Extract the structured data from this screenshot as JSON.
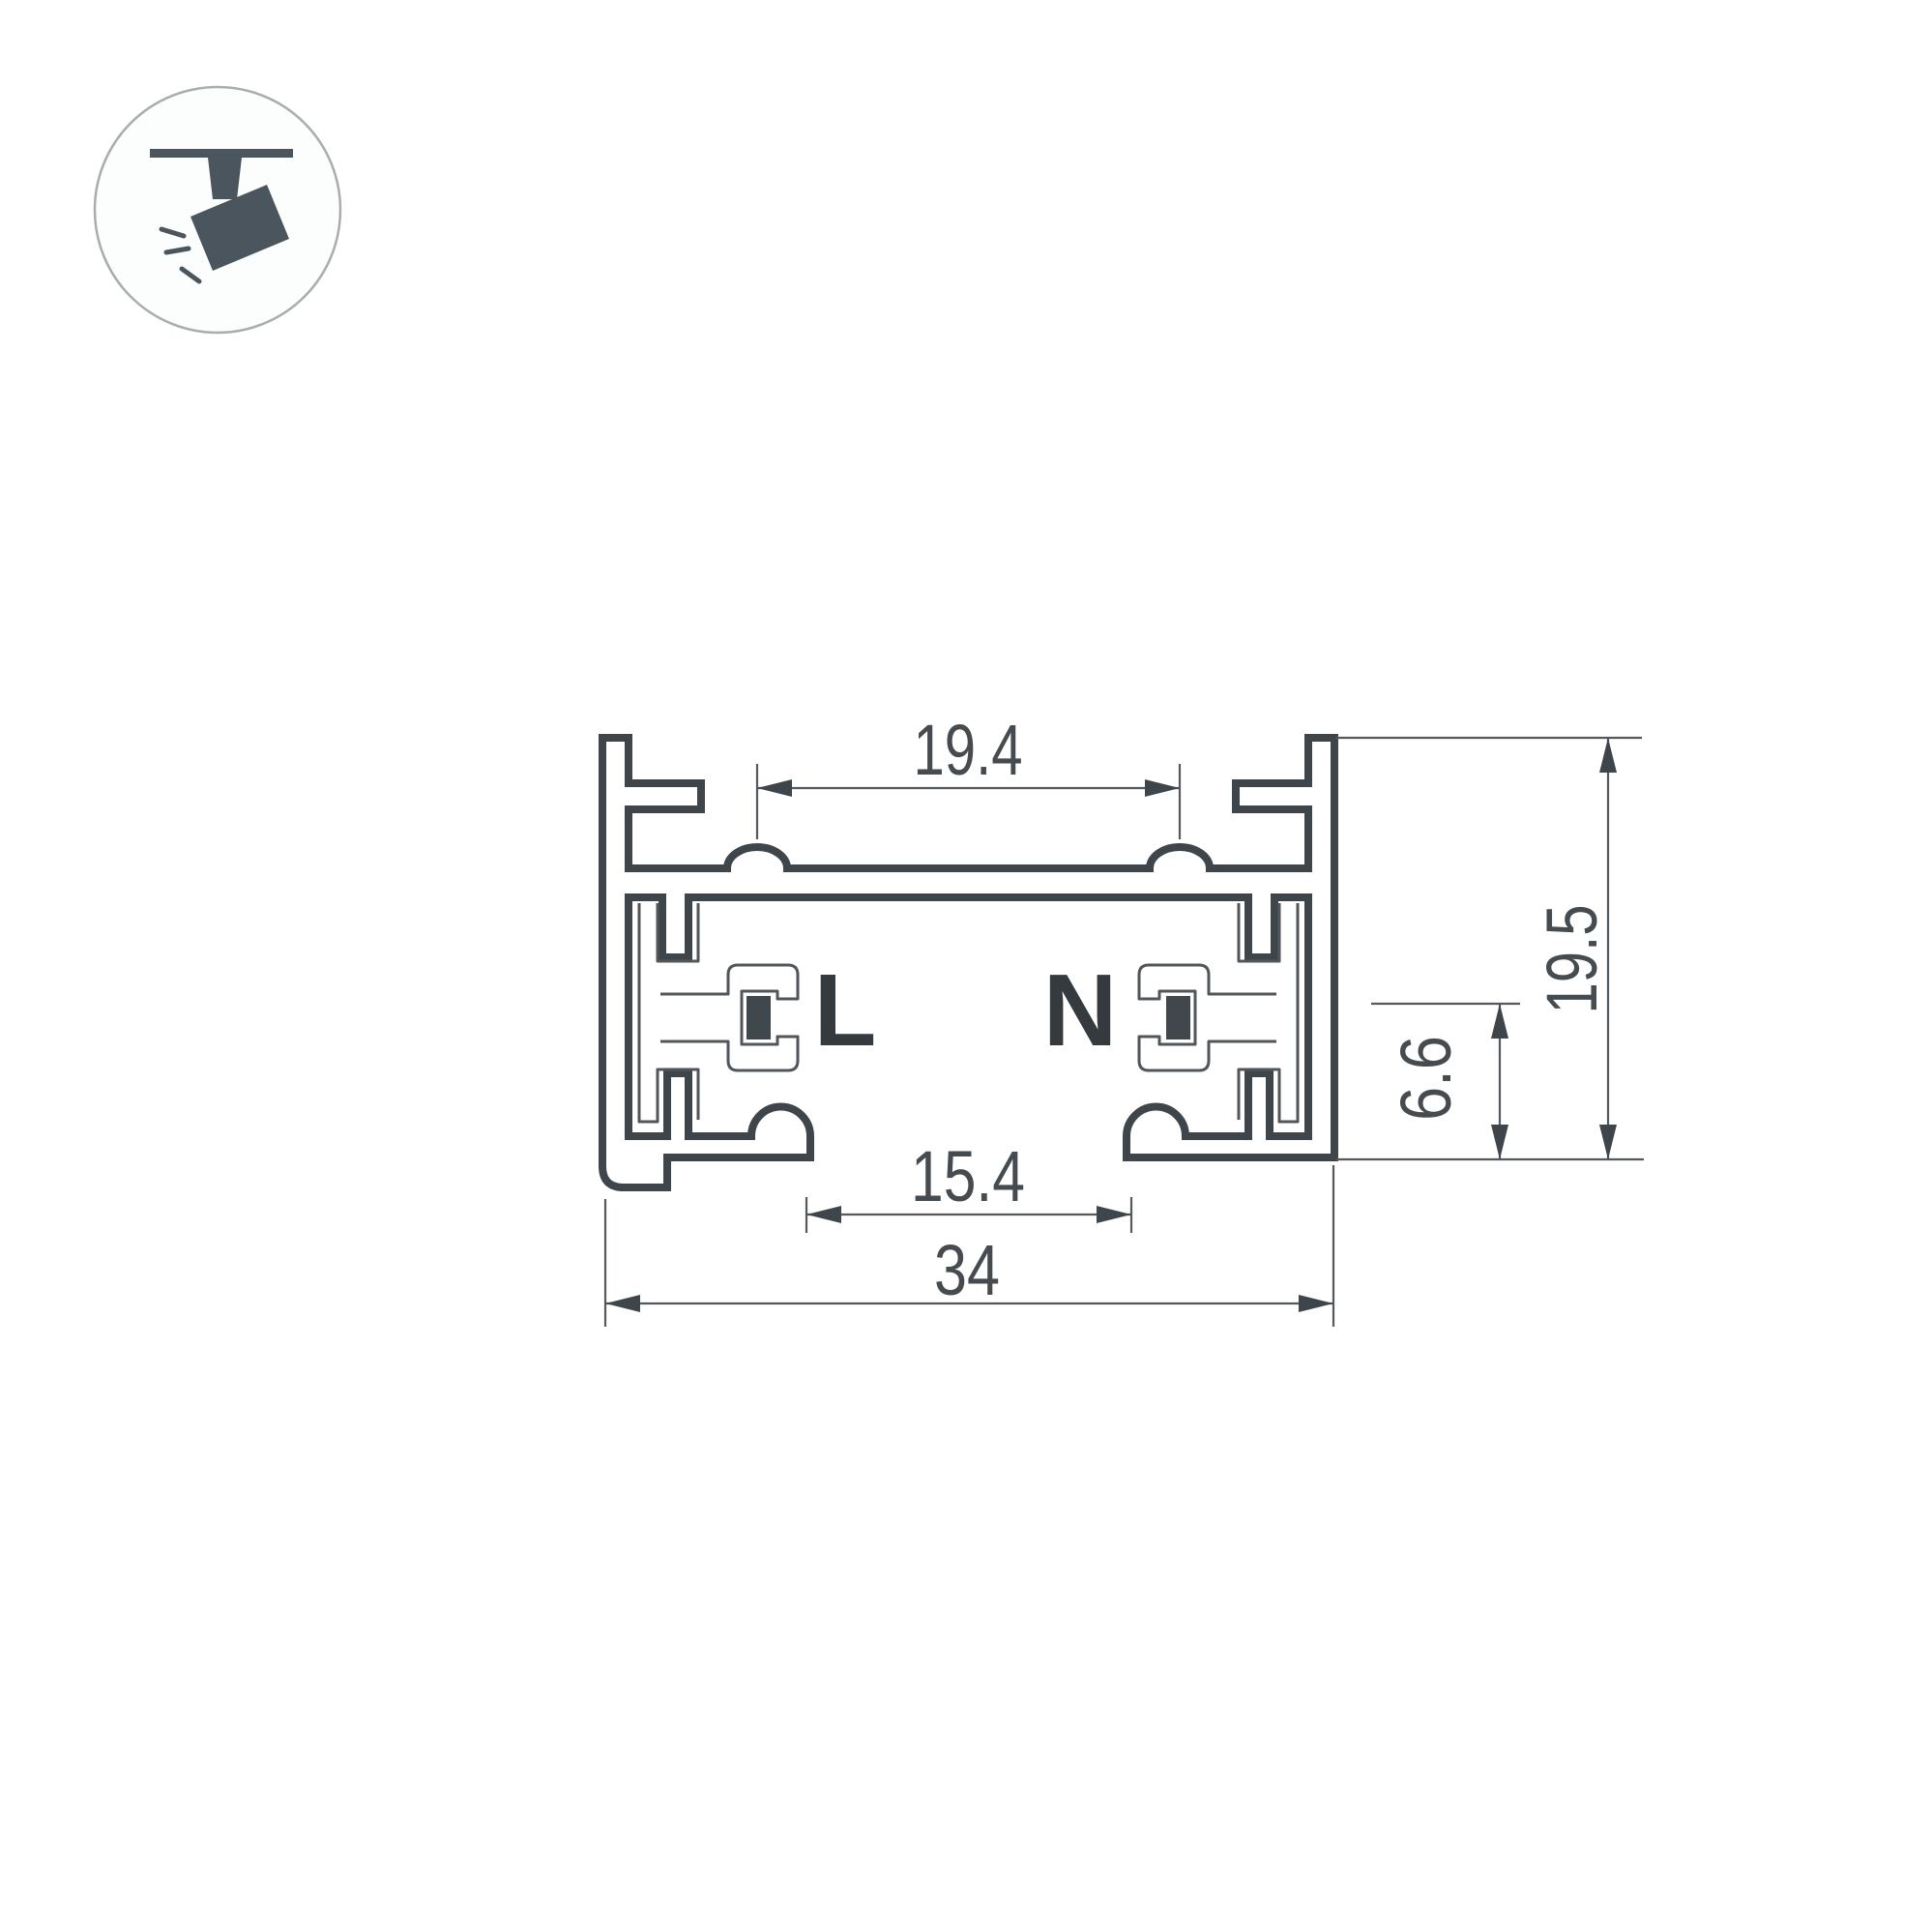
{
  "drawing": {
    "type": "track-profile-cross-section",
    "conductors": {
      "live": "L",
      "neutral": "N"
    },
    "dimensions": {
      "inner_top_width": "19.4",
      "bottom_opening_width": "15.4",
      "overall_width": "34",
      "overall_height": "19.5",
      "conductor_height": "6.6"
    },
    "icon": {
      "name": "ceiling-track-spotlight"
    },
    "colors": {
      "background": "#ffffff",
      "profile_outline": "#3f464b",
      "insulator_line": "#51565a",
      "dimension_line": "#54595d",
      "dimension_text": "#454b4f",
      "conductor_fill": "#41484d",
      "label_text": "#343a3e",
      "icon_fill": "#4a555d",
      "icon_circle_stroke": "#a8adaf"
    }
  }
}
